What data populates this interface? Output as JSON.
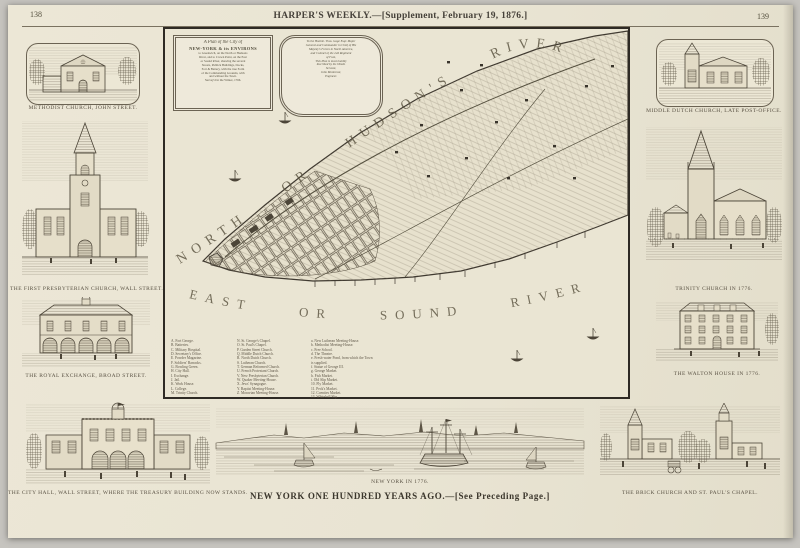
{
  "page": {
    "left_page_number": "138",
    "right_page_number": "139",
    "header_title": "HARPER'S WEEKLY.—[Supplement, February 19, 1876.]",
    "main_caption": "NEW YORK ONE HUNDRED YEARS AGO.—[See Preceding Page.]"
  },
  "map": {
    "river_labels": {
      "north": "NORTH OR HUDSON'S RIVER",
      "east": "EAST OR SOUND RIVER"
    },
    "cartouche": {
      "title_lines": [
        "A Plan of the City of",
        "NEW-YORK & its ENVIRONS",
        "to Greenwich, on the North or Hudsons",
        "River, and to Crown Point, on the East",
        "or Sound River, shewing the several",
        "Streets, Publick Buildings, Docks,",
        "Fort & Battery, with the true Form",
        "of the Commanding Grounds, with",
        "and without the Town.",
        "Survey'd in the Winter, 1766."
      ],
      "dedication_lines": [
        "To the Honble. Thos. Gage Esqr. Major",
        "General and Commander in Chief of His",
        "Majesty's Forces in North America,",
        "and Colonel of the 22d Regiment",
        "of Foot,",
        "This Plan is most humbly",
        "Inscribed by his Obedt.",
        "Servant,",
        "John Montresor,",
        "Engineer."
      ]
    },
    "legend": {
      "col1": [
        "A. Fort George.",
        "B. Batteries.",
        "C. Military Hospital.",
        "D. Secretary's Office.",
        "E. Powder Magazine.",
        "F. Soldiers' Barracks.",
        "G. Bowling Green.",
        "H. City Hall.",
        "I. Exchange.",
        "J. Jail.",
        "K. Work House.",
        "L. College.",
        "M. Trinity Church."
      ],
      "col2": [
        "N. St. George's Chapel.",
        "O. St. Paul's Chapel.",
        "P. Garden Street Church.",
        "Q. Middle Dutch Church.",
        "R. North Dutch Church.",
        "S. Lutheran Church.",
        "T. German Reformed Church.",
        "U. French Protestant Church.",
        "V. New Presbyterian Church.",
        "W. Quaker Meeting-House.",
        "X. Jews' Synagogue.",
        "Y. Baptist Meeting-House.",
        "Z. Moravian Meeting-House."
      ],
      "col3": [
        "a. New Lutheran Meeting-House.",
        "b. Methodist Meeting-House.",
        "c. Free School.",
        "d. The Theatre.",
        "e. Fresh-water Pond, from which the Town",
        "      is supplied.",
        "f. Statue of George III.",
        "g. George Market.",
        "h. Fish Market.",
        "i. Old Slip Market.",
        "10. Fly Market.",
        "11. Peck's Market.",
        "12. Coenties Market.",
        "13. Whitehall Slip."
      ]
    }
  },
  "engravings": {
    "methodist_church": {
      "caption": "METHODIST CHURCH, JOHN STREET."
    },
    "first_presbyterian": {
      "caption": "THE FIRST PRESBYTERIAN CHURCH, WALL STREET."
    },
    "royal_exchange": {
      "caption": "THE ROYAL EXCHANGE, BROAD STREET."
    },
    "middle_dutch": {
      "caption": "MIDDLE DUTCH CHURCH, LATE POST-OFFICE."
    },
    "trinity": {
      "caption": "TRINITY CHURCH IN 1776."
    },
    "walton_house": {
      "caption": "THE WALTON HOUSE IN 1776."
    },
    "city_hall": {
      "caption": "THE CITY HALL, WALL STREET, WHERE THE TREASURY BUILDING NOW STANDS."
    },
    "new_york_1776": {
      "caption": "NEW YORK IN 1776."
    },
    "brick_church": {
      "caption": "THE BRICK CHURCH AND ST. PAUL'S CHAPEL."
    }
  },
  "colors": {
    "paper": "#e9e4d3",
    "ink": "#4c4538",
    "frame": "#2e2a24"
  }
}
